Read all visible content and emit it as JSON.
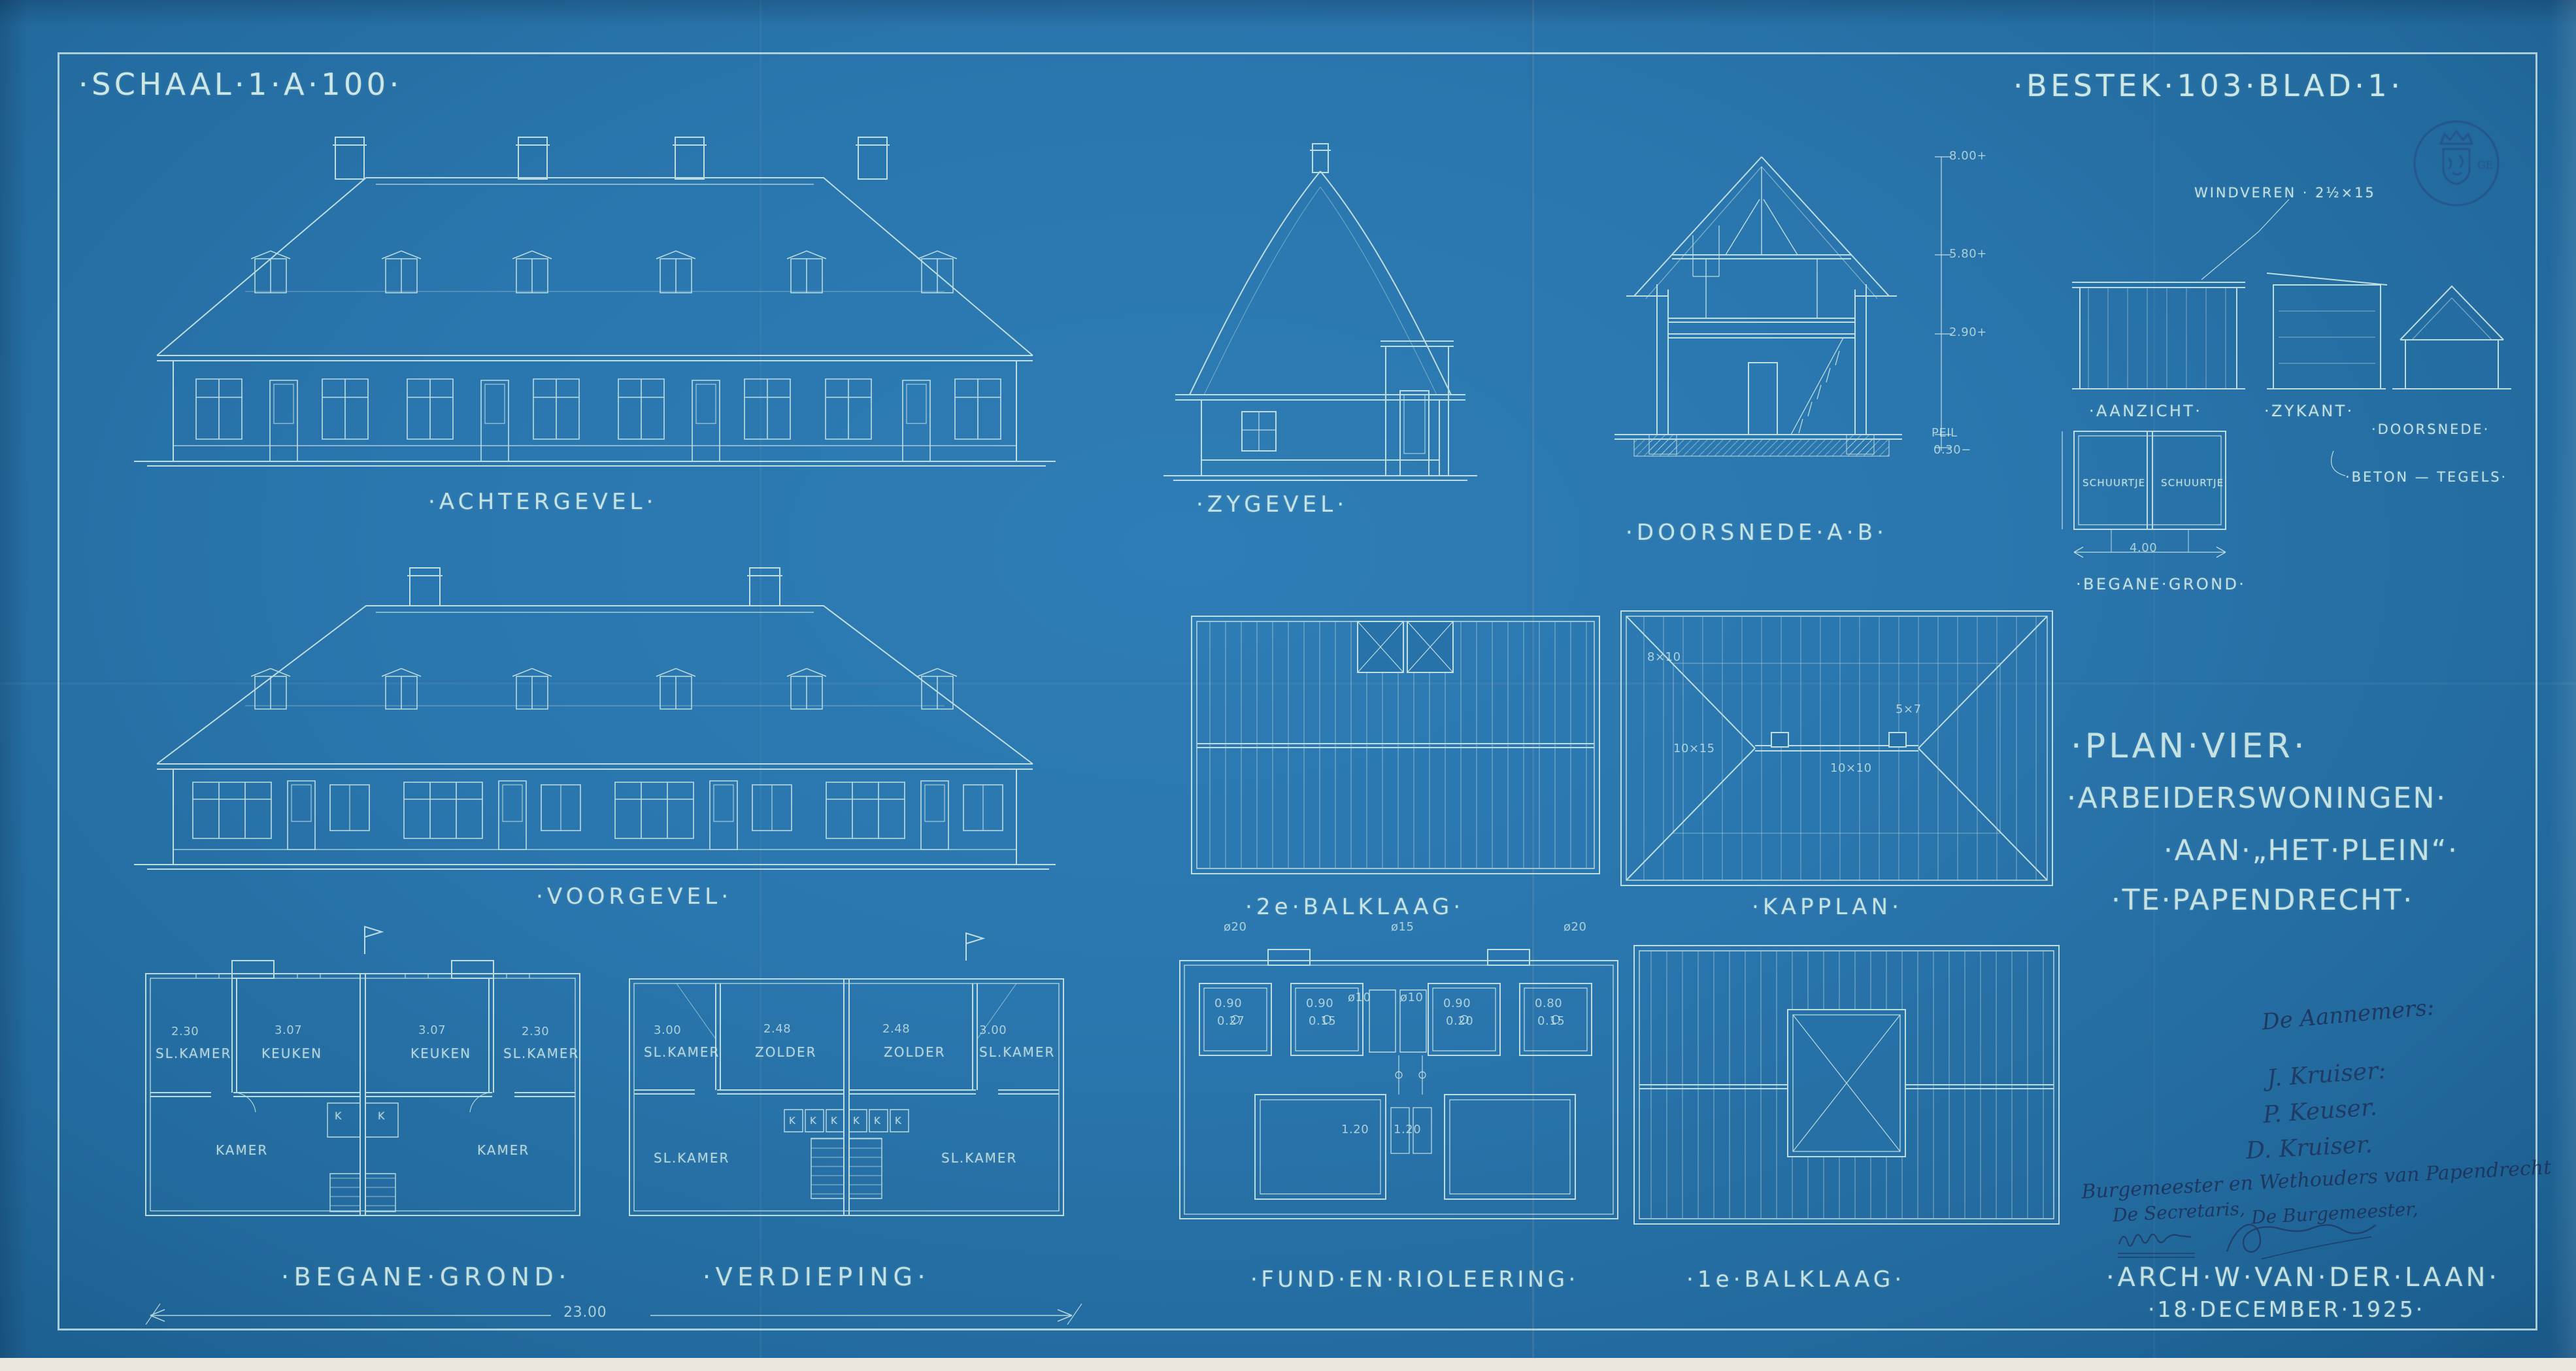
{
  "colors": {
    "paper": "#2873aa",
    "line": "#d7efe8",
    "ink": "#1e2d55",
    "stamp": "#26407e"
  },
  "titles": {
    "scale": "·SCHAAL·1·A·100·",
    "bestek": "·BESTEK·103·BLAD·1·"
  },
  "drawings": {
    "achtergevel": {
      "label": "·ACHTERGEVEL·"
    },
    "zygevel": {
      "label": "·ZYGEVEL·"
    },
    "doorsnede": {
      "label": "·DOORSNEDE·A·B·",
      "levels": [
        "8.00+",
        "5.80+",
        "2.90+",
        "PEIL",
        "0.30−"
      ]
    },
    "sheds": {
      "aanzicht_label": "·AANZICHT·",
      "zykant_label": "·ZYKANT·",
      "doorsnede_label": "·DOORSNEDE·",
      "windveren_note": "WINDVEREN · 2½×15",
      "beton_note": "·BETON — TEGELS·",
      "plan": {
        "label": "·BEGANE·GROND·",
        "rooms": [
          "SCHUURTJE",
          "SCHUURTJE"
        ],
        "width_dim": "4.00"
      }
    },
    "voorgevel": {
      "label": "·VOORGEVEL·"
    },
    "balklaag2": {
      "label": "·2e·BALKLAAG·"
    },
    "kapplan": {
      "label": "·KAPPLAN·",
      "notes": [
        "8×10",
        "10×15",
        "10×10",
        "5×7"
      ]
    },
    "project": {
      "lines": [
        "·PLAN·VIER·",
        "·ARBEIDERSWONINGEN·",
        "·AAN·„HET·PLEIN“·",
        "·TE·PAPENDRECHT·"
      ]
    },
    "begane_grond": {
      "label": "·BEGANE·GROND·",
      "rooms_top": [
        "SL.KAMER",
        "KEUKEN",
        "KEUKEN",
        "SL.KAMER"
      ],
      "rooms_bottom": [
        "KAMER",
        "KAMER"
      ],
      "dims_top": [
        "2.30",
        "3.07",
        "3.07",
        "2.30"
      ],
      "closet": "K"
    },
    "verdieping": {
      "label": "·VERDIEPING·",
      "rooms_top": [
        "SL.KAMER",
        "ZOLDER",
        "ZOLDER",
        "SL.KAMER"
      ],
      "rooms_bottom": [
        "SL.KAMER",
        "SL.KAMER"
      ],
      "dims_top": [
        "3.00",
        "2.48",
        "2.48",
        "3.00"
      ],
      "closet": "K"
    },
    "total_width_dim": "23.00",
    "fund": {
      "label": "·FUND·EN·RIOLEERING·",
      "pile_dims": [
        "ø20",
        "ø15",
        "ø20"
      ],
      "cells": [
        [
          "0.90",
          "0.27"
        ],
        [
          "0.90",
          "0.15"
        ],
        [
          "0.90",
          "0.20"
        ],
        [
          "0.80",
          "0.15"
        ]
      ],
      "mid_dims": [
        "ø10",
        "ø10"
      ],
      "lower_dims": [
        "1.20",
        "1.20"
      ]
    },
    "balklaag1": {
      "label": "·1e·BALKLAAG·"
    }
  },
  "signing": {
    "aannemers_heading": "De Aannemers:",
    "aannemer_names": [
      "J. Kruiser:",
      "P. Keuser.",
      "D. Kruiser."
    ],
    "college_line": "Burgemeester en Wethouders van Papendrecht",
    "secretaris_label": "De Secretaris,",
    "burgemeester_label": "De Burgemeester,",
    "architect": "·ARCH·W·VAN·DER·LAAN·",
    "date": "·18·DECEMBER·1925·"
  }
}
